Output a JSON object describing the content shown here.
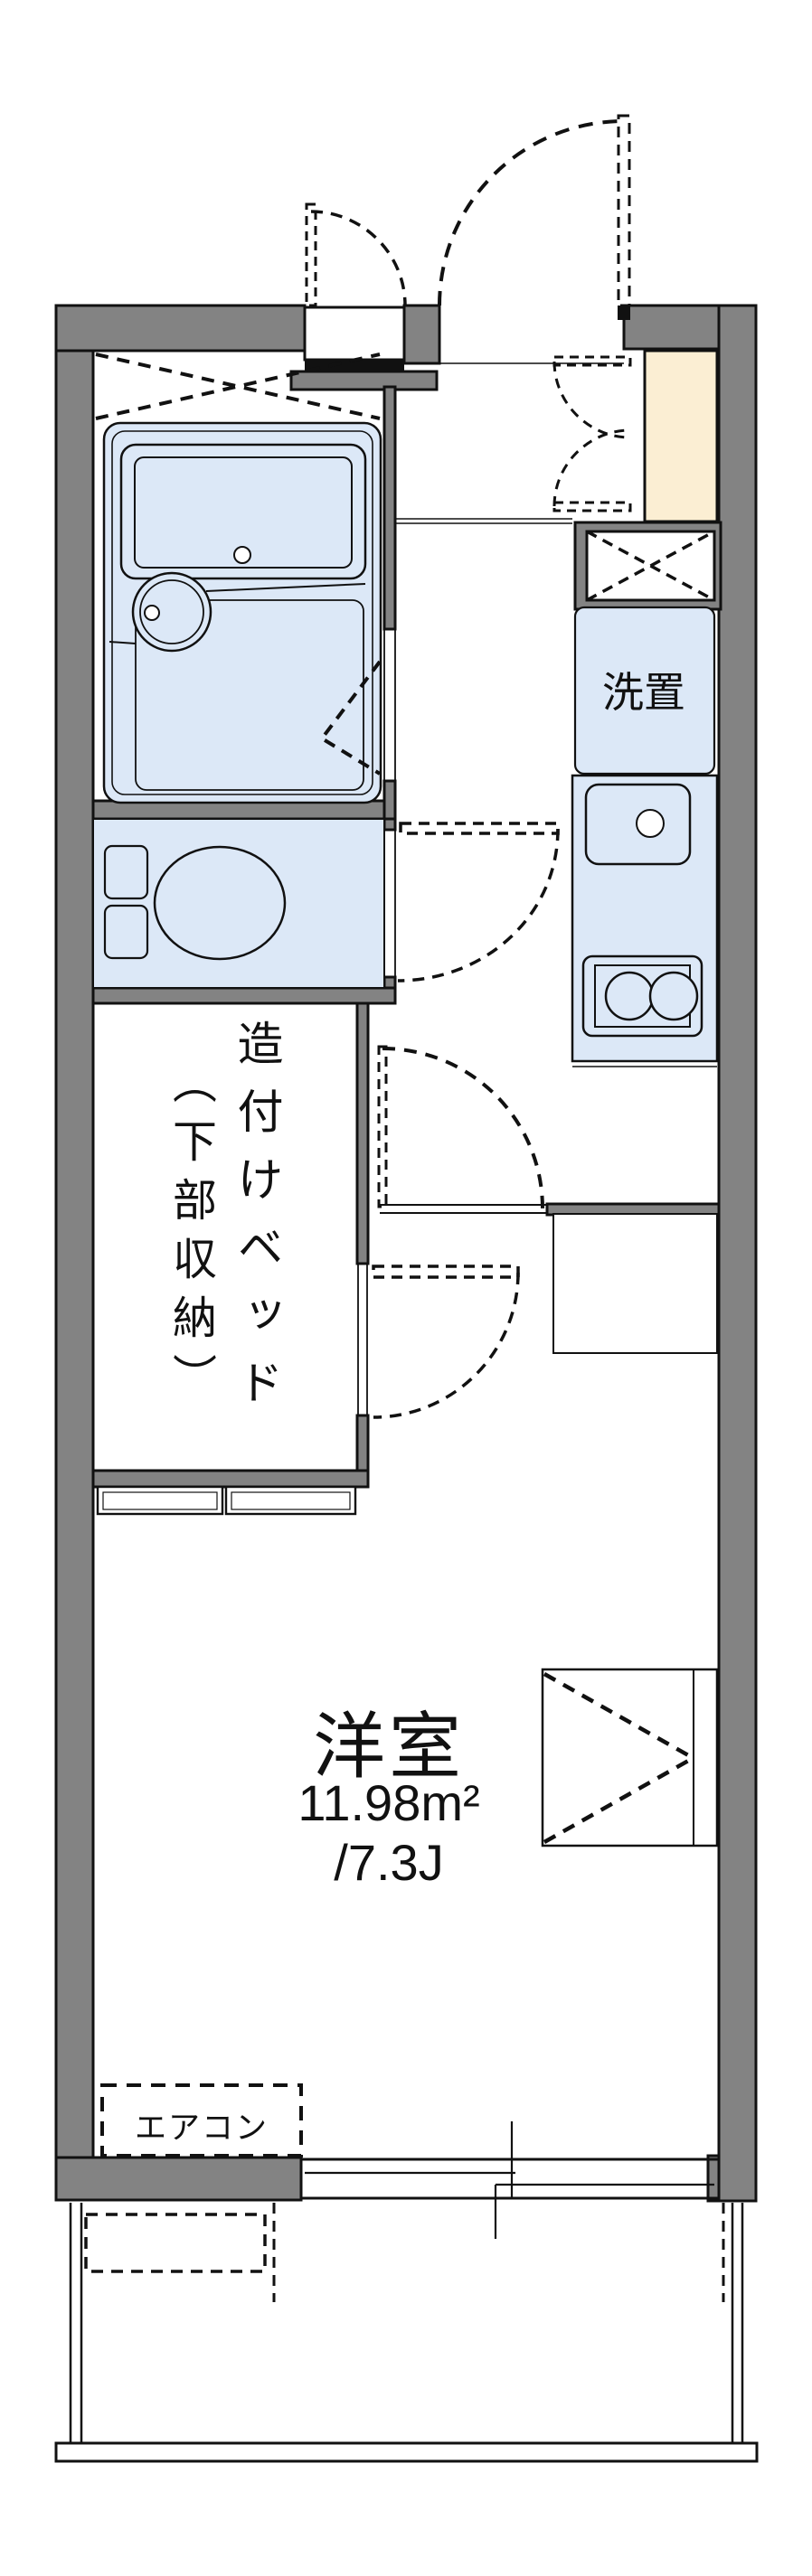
{
  "plan": {
    "labels": {
      "room_name": "洋室",
      "room_area": "11.98m²",
      "room_tatami": "/7.3J",
      "washer": "洗置",
      "bed_main": "造付けベッド",
      "bed_sub": "（下部収納）",
      "aircon": "エアコン"
    },
    "colors": {
      "wall_gray": "#838383",
      "fixture_blue": "#dce8f7",
      "cabinet_cream": "#fbeed3",
      "line_black": "#111111",
      "background": "#ffffff"
    }
  }
}
